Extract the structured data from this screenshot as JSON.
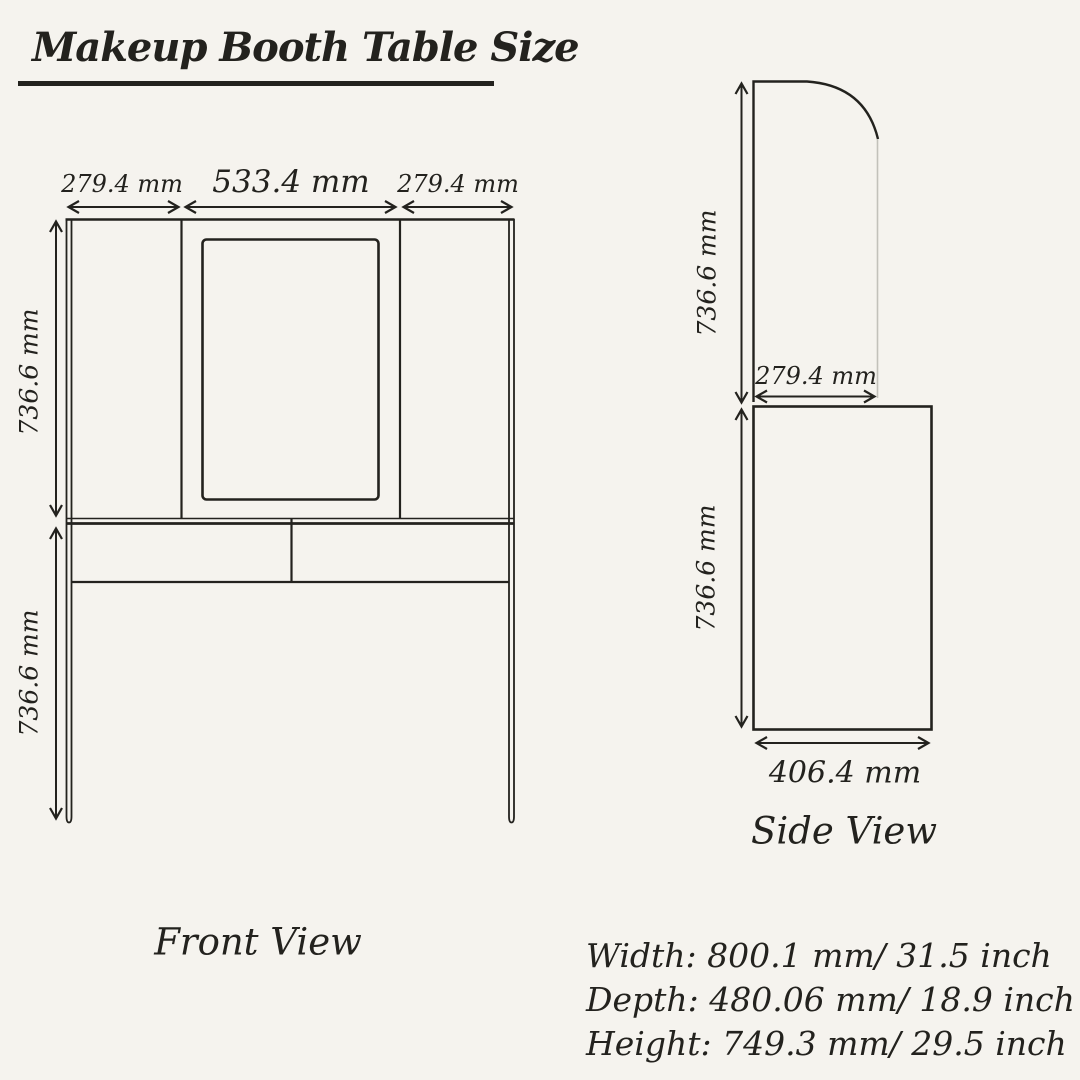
{
  "header": {
    "title": "Makeup Booth Table Size"
  },
  "front": {
    "label": "Front View",
    "dim_left_width": "279.4 mm",
    "dim_center_width": "533.4 mm",
    "dim_right_width": "279.4 mm",
    "dim_upper_height": "736.6 mm",
    "dim_lower_height": "736.6 mm"
  },
  "side": {
    "label": "Side View",
    "dim_panel_height": "736.6 mm",
    "dim_panel_depth": "279.4 mm",
    "dim_table_height": "736.6 mm",
    "dim_table_depth": "406.4 mm"
  },
  "specs": {
    "width": "Width: 800.1 mm/ 31.5 inch",
    "depth": "Depth: 480.06 mm/ 18.9 inch",
    "height": "Height: 749.3 mm/ 29.5 inch"
  },
  "colors": {
    "background": "#f5f3ee",
    "ink": "#23221e",
    "muted_line": "#c2c1ba"
  }
}
